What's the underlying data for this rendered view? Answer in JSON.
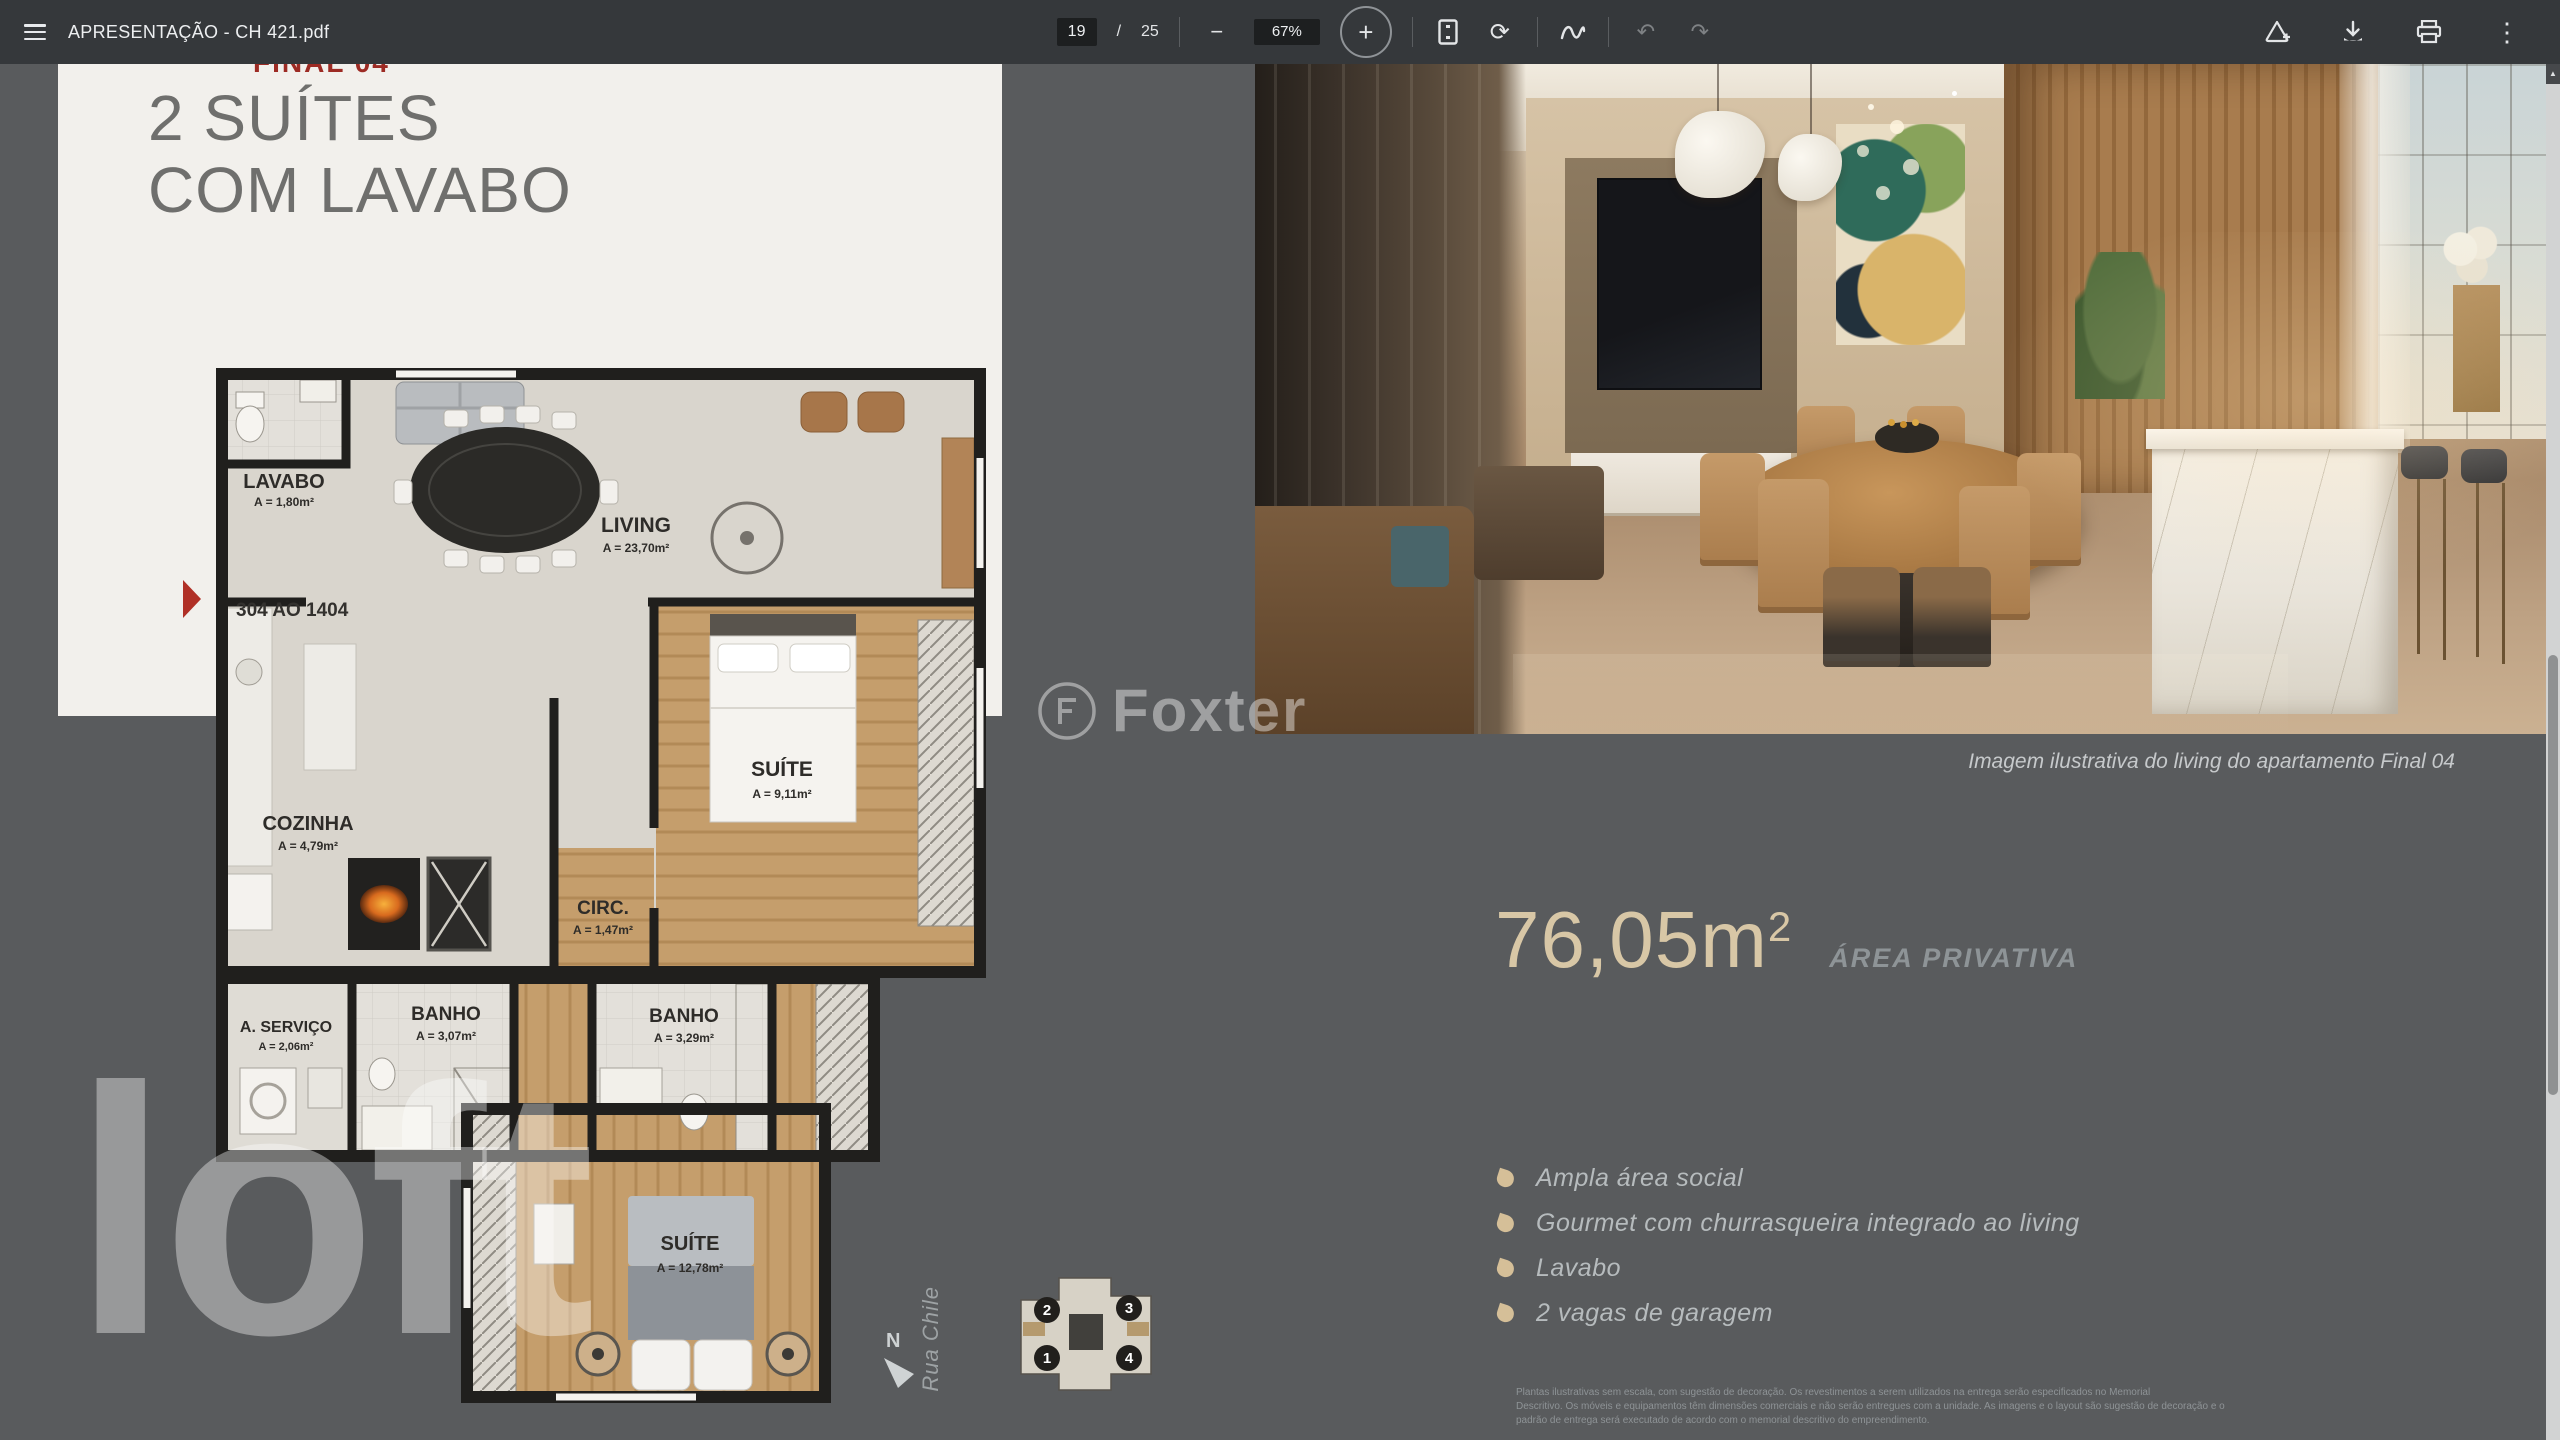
{
  "toolbar": {
    "title": "APRESENTAÇÃO - CH 421.pdf",
    "page_current": "19",
    "page_separator": "/",
    "page_total": "25",
    "zoom_level": "67%",
    "glyphs": {
      "minus": "−",
      "plus": "+",
      "rotate": "⟳",
      "undo": "↶",
      "redo": "↷",
      "kebab": "⋮",
      "up_arrow": "▲"
    }
  },
  "slide": {
    "overflow_heading": "FINAL 04",
    "title_line1": "2 SUÍTES",
    "title_line2": "COM LAVABO",
    "unit_range": "304 AO 1404",
    "floorplan": {
      "rooms": [
        {
          "name": "LAVABO",
          "area": "A = 1,80m²"
        },
        {
          "name": "LIVING",
          "area": "A = 23,70m²"
        },
        {
          "name": "COZINHA",
          "area": "A = 4,79m²"
        },
        {
          "name": "SUÍTE",
          "area": "A = 9,11m²"
        },
        {
          "name": "CIRC.",
          "area": "A = 1,47m²"
        },
        {
          "name": "A. SERVIÇO",
          "area": "A = 2,06m²"
        },
        {
          "name": "BANHO",
          "area": "A = 3,07m²"
        },
        {
          "name": "BANHO",
          "area": "A = 3,29m²"
        },
        {
          "name": "SUÍTE",
          "area": "A = 12,78m²"
        }
      ],
      "compass_label": "N",
      "street_label": "Rua Chile"
    },
    "keyplan_units": [
      "2",
      "3",
      "1",
      "4"
    ],
    "watermark_center": "Foxter",
    "watermark_corner": "loft",
    "photo_caption": "Imagem ilustrativa do living do apartamento Final 04",
    "private_area": {
      "value": "76,05m",
      "sup": "2",
      "label": "ÁREA PRIVATIVA"
    },
    "features": [
      "Ampla área social",
      "Gourmet com churrasqueira integrado ao living",
      "Lavabo",
      "2 vagas de garagem"
    ],
    "disclaimer_lines": [
      "Plantas ilustrativas sem escala, com sugestão de decoração. Os revestimentos a serem utilizados na entrega serão especificados no Memorial",
      "Descritivo. Os móveis e equipamentos têm dimensões comerciais e não serão entregues com a unidade. As imagens e o layout são sugestão de decoração e o",
      "padrão de entrega será executado de acordo com o memorial descritivo do empreendimento."
    ]
  },
  "colors": {
    "accent_tan": "#d8c7a6",
    "marker_red": "#b03026"
  }
}
